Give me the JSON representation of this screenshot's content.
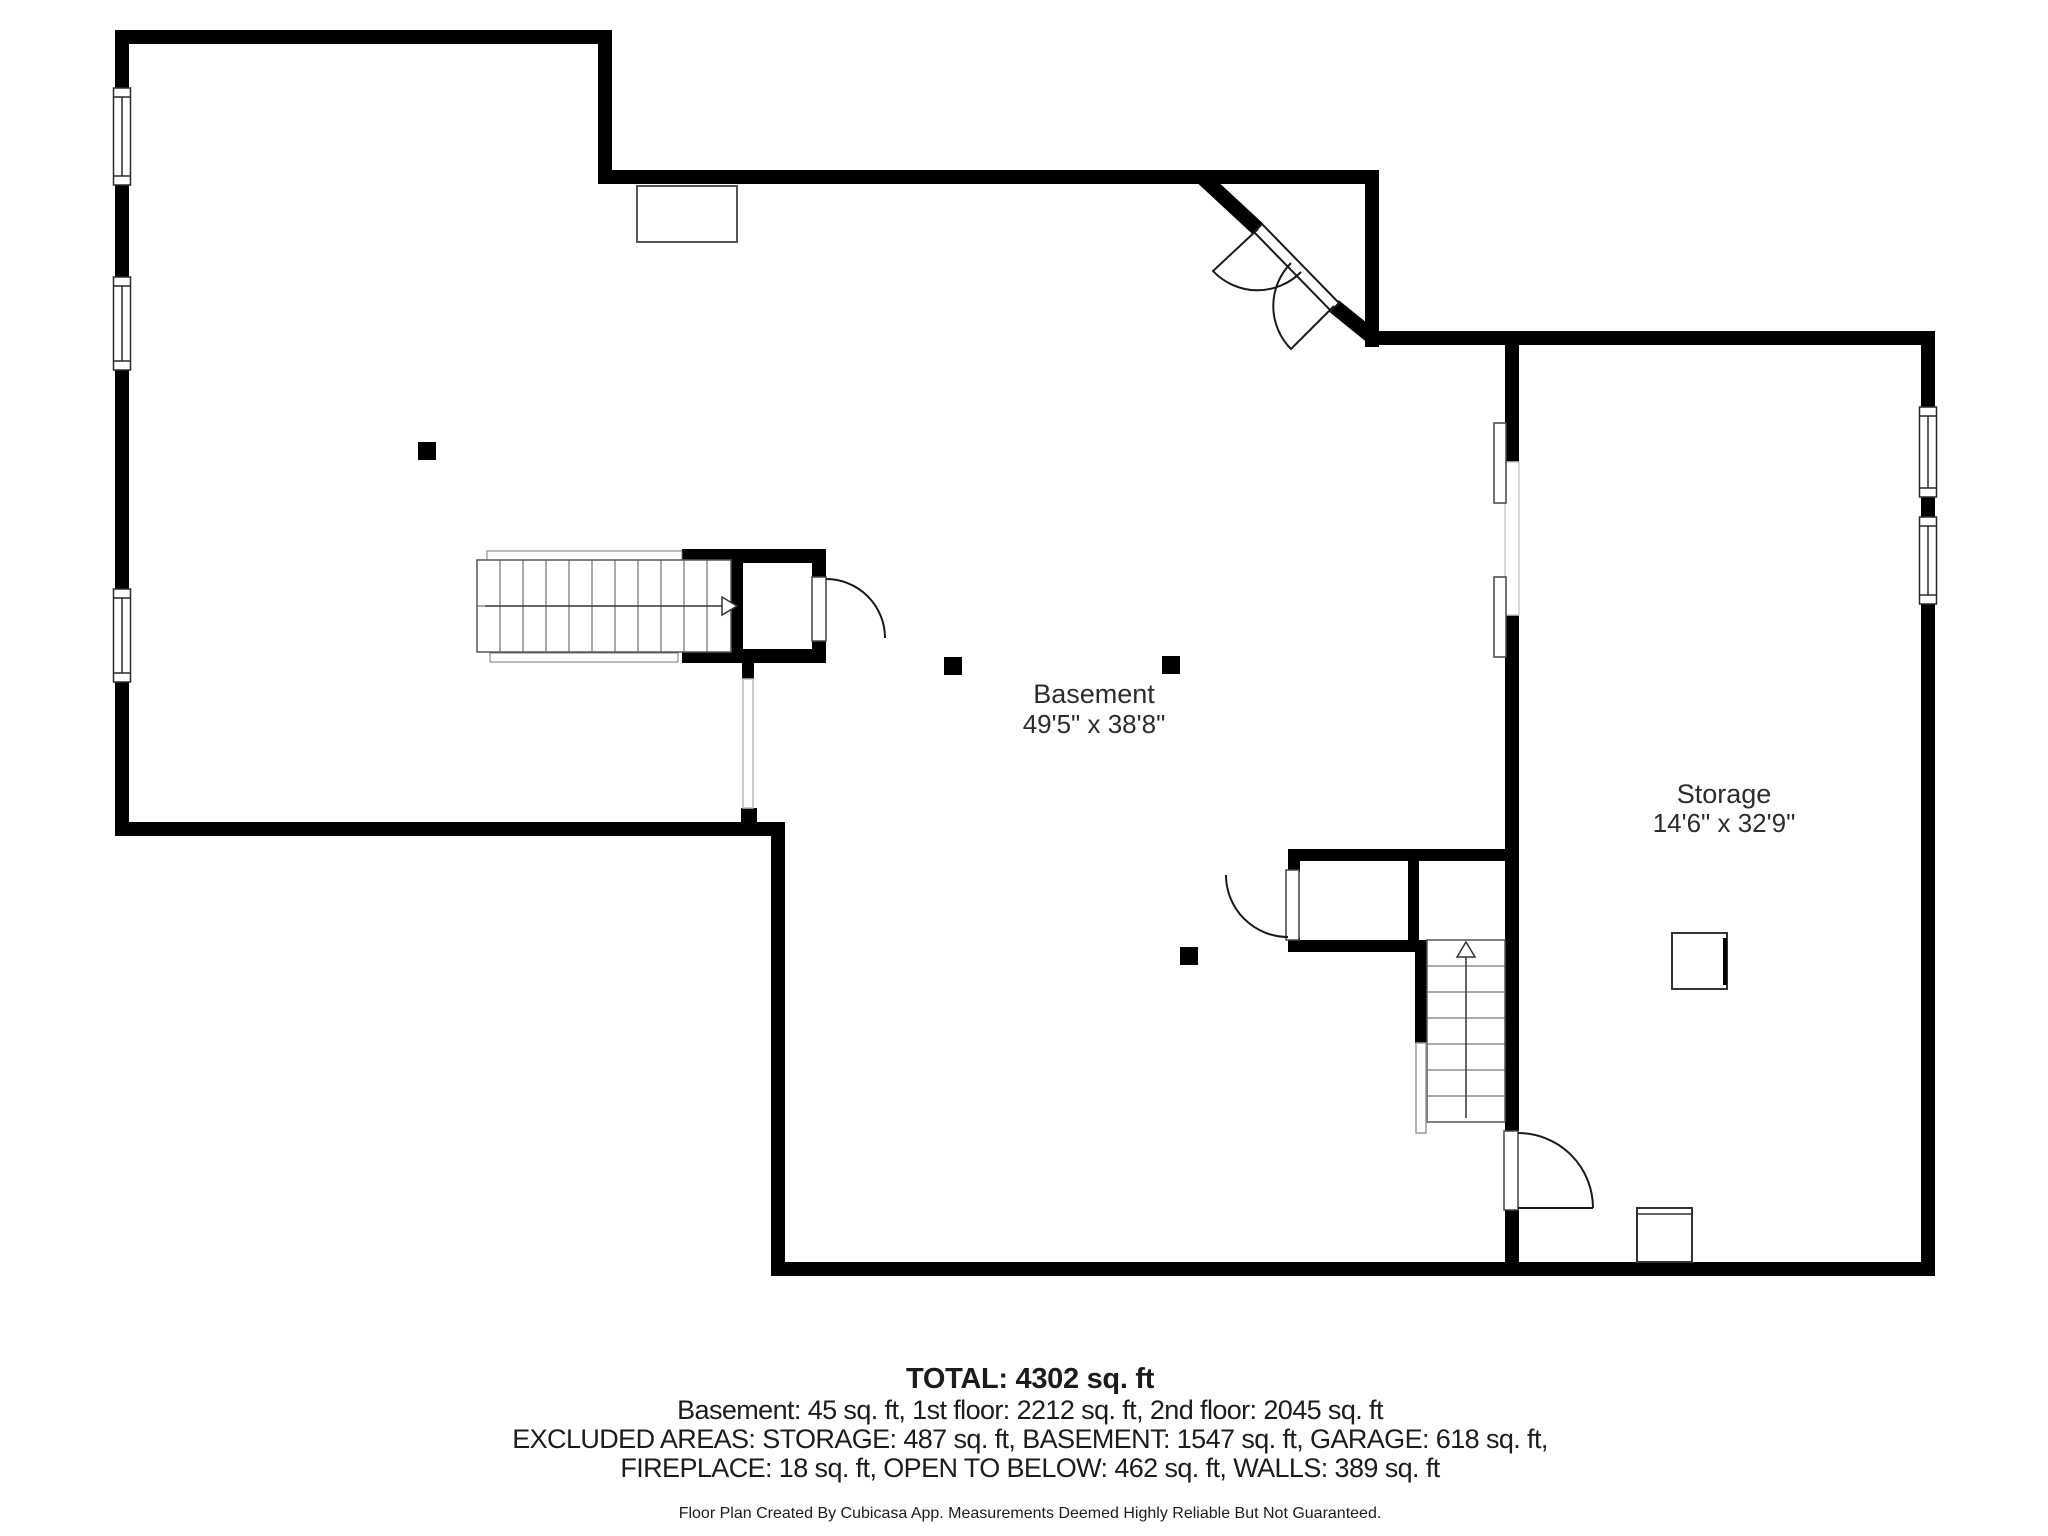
{
  "plan": {
    "wall_color": "#000000",
    "line_color": "#4d4d4d",
    "background": "#ffffff",
    "rooms": [
      {
        "name": "Basement",
        "dimensions": "49'5\" x 38'8\""
      },
      {
        "name": "Storage",
        "dimensions": "14'6\" x 32'9\""
      }
    ],
    "symbols": {
      "windows": 5,
      "doors": 5,
      "stairways": 2,
      "posts": 4
    }
  },
  "footer": {
    "total": "TOTAL: 4302 sq. ft",
    "floors": "Basement: 45 sq. ft, 1st floor: 2212 sq. ft, 2nd floor: 2045 sq. ft",
    "excluded1": "EXCLUDED AREAS: STORAGE: 487 sq. ft, BASEMENT: 1547 sq. ft, GARAGE: 618 sq. ft,",
    "excluded2": "FIREPLACE: 18 sq. ft, OPEN TO BELOW: 462 sq. ft, WALLS: 389 sq. ft",
    "disclaimer": "Floor Plan Created By Cubicasa App. Measurements Deemed Highly Reliable But Not Guaranteed."
  }
}
